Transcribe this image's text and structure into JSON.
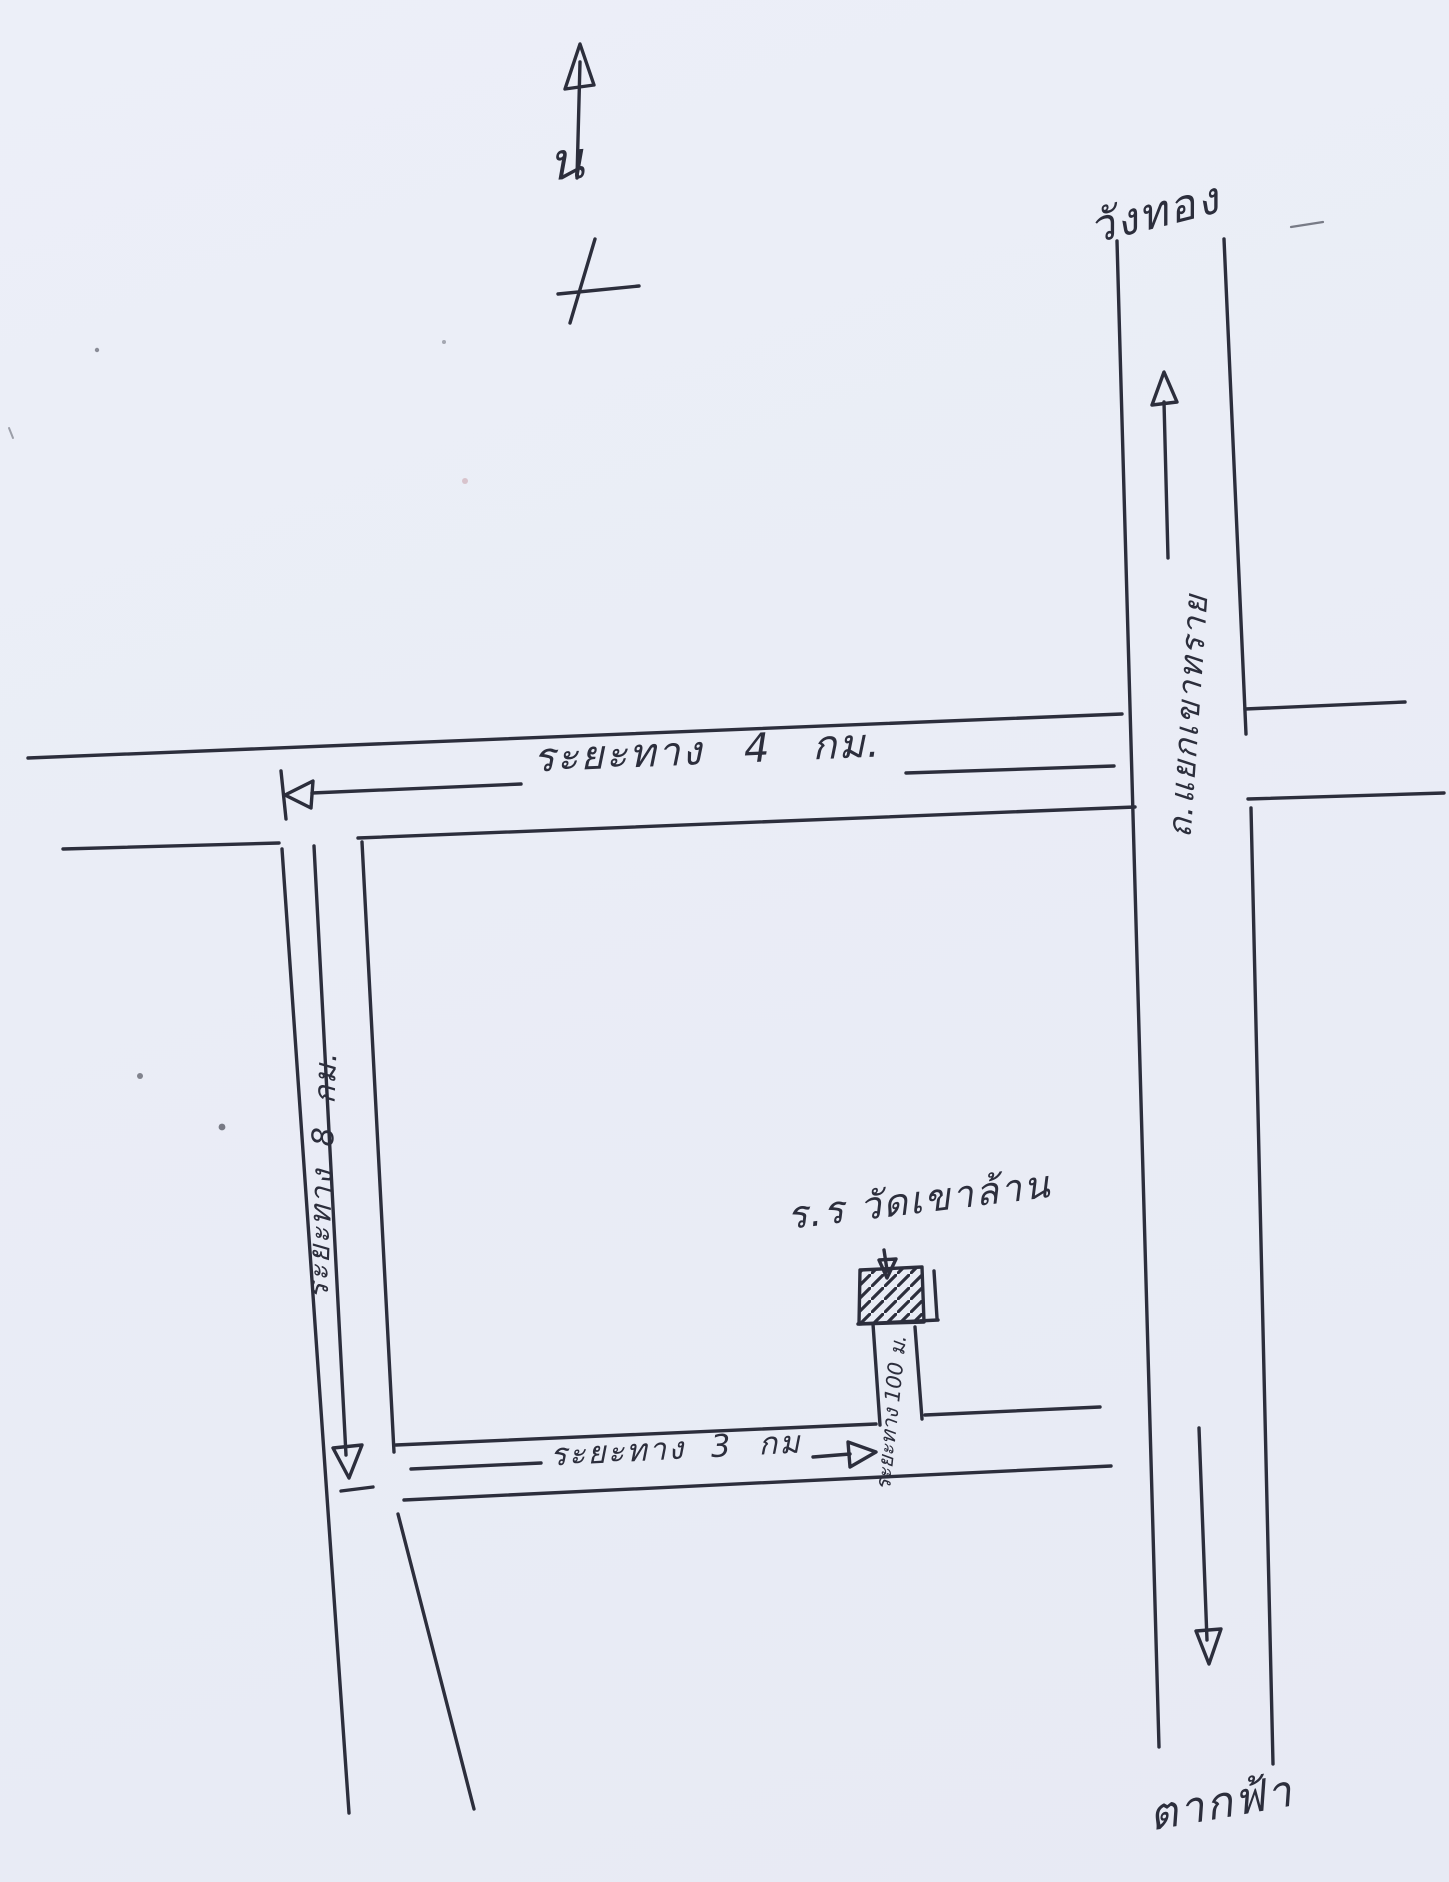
{
  "compass": {
    "north_letter": "น"
  },
  "labels": {
    "top_destination": "วังทอง",
    "highway_name": "ถ.แยกเขาทราย",
    "main_road_distance": "ระยะทาง 4 กม.",
    "left_road_distance": "ระยะทาง 8 กม.",
    "bottom_road_distance": "ระยะทาง 3 กม",
    "driveway_distance": "ระยะทาง 100 ม.",
    "school_name": "ร.ร วัดเขาล้าน",
    "bottom_destination": "ตากฟ้า"
  },
  "colors": {
    "ink": "#2c2e3c",
    "paper": "#eaedf6"
  }
}
